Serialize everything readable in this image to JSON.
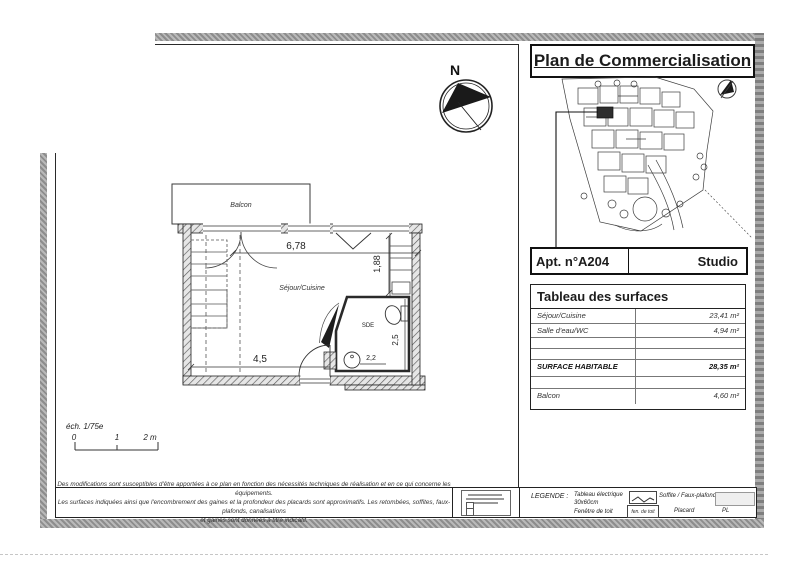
{
  "header": {
    "title": "Plan de Commercialisation"
  },
  "apartment": {
    "number": "Apt. n°A204",
    "type": "Studio"
  },
  "surfaces": {
    "header": "Tableau des surfaces",
    "rows": [
      {
        "label": "Séjour/Cuisine",
        "value": "23,41 m²"
      },
      {
        "label": "Salle d'eau/WC",
        "value": "4,94 m²"
      },
      {
        "label": "",
        "value": ""
      },
      {
        "label": "",
        "value": ""
      },
      {
        "label": "SURFACE HABITABLE",
        "value": "28,35 m²"
      },
      {
        "label": "",
        "value": ""
      },
      {
        "label": "Balcon",
        "value": "4,60 m²"
      }
    ]
  },
  "floor_plan": {
    "room_labels": {
      "balcony": "Balcon",
      "living": "Séjour/Cuisine",
      "bathroom": "SDE"
    },
    "dimensions": {
      "living_width_top": "6,78",
      "living_depth_right": "1,88",
      "living_width_bottom": "4,5",
      "bathroom_depth": "2,5",
      "bathroom_width": "2,2"
    },
    "north": {
      "label": "N"
    },
    "scale": {
      "label": "éch. 1/75e",
      "tick_0": "0",
      "tick_1": "1",
      "tick_2": "2 m"
    }
  },
  "footer": {
    "disclaimer": {
      "line1": "Des modifications sont susceptibles d'être apportées à ce plan en fonction des nécessités techniques de réalisation et en ce qui concerne les équipements.",
      "line2": "Les surfaces indiquées ainsi que l'encombrement des gaines et la profondeur des placards sont approximatifs. Les retombées, soffites, faux-plafonds, canalisations",
      "line3": "et gaines sont données à titre indicatif."
    },
    "legend": {
      "title": "LEGENDE :",
      "electrical_panel_label_1": "Tableau électrique",
      "electrical_panel_label_2": "30x60cm",
      "roof_window_label": "Fenêtre de toit",
      "roof_window_symbol_text": "fen. de toit",
      "soffit_label": "Soffite / Faux-plafond",
      "closet_label": "Placard",
      "closet_symbol_text": "PL"
    }
  }
}
